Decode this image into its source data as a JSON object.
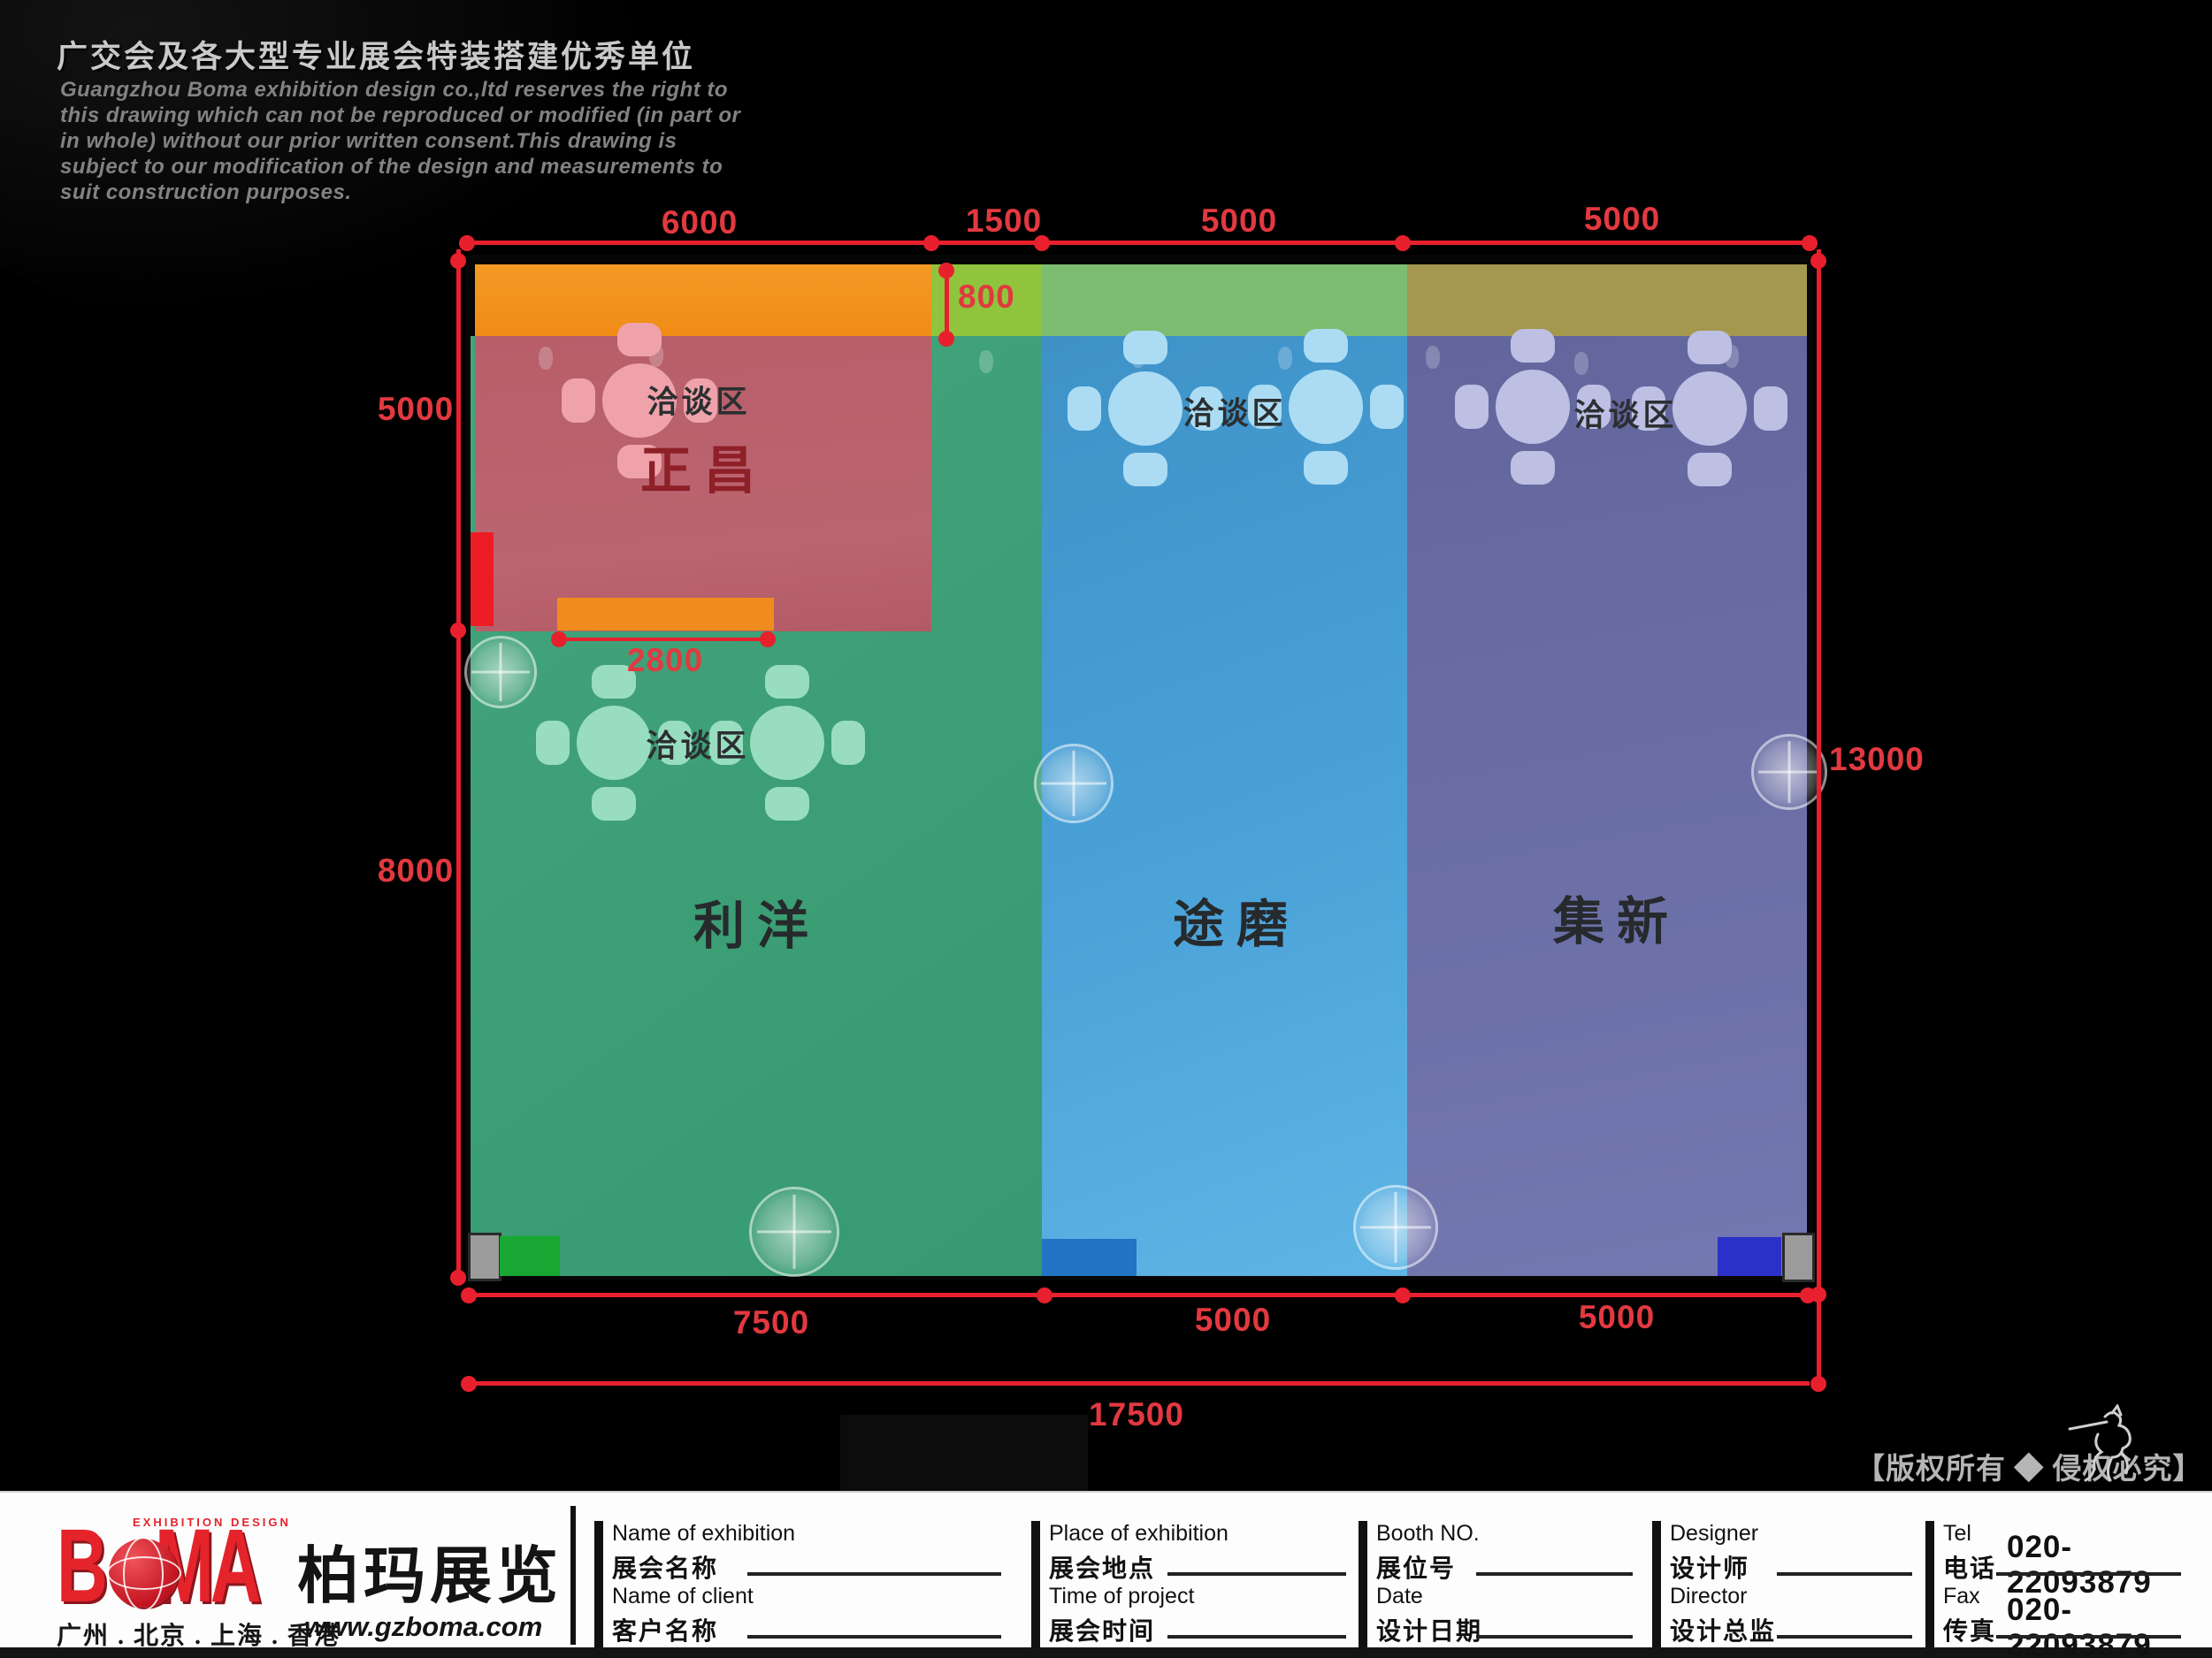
{
  "header": {
    "title": "广交会及各大型专业展会特装搭建优秀单位",
    "disclaimer": [
      "Guangzhou Boma exhibition design co.,ltd reserves the right to",
      "this drawing which can not be reproduced or modified (in part or",
      "in whole) without our prior written consent.This drawing is",
      "subject to our modification of the design and measurements to",
      "suit construction purposes."
    ]
  },
  "plan": {
    "zones": [
      {
        "id": "zhengchang",
        "name": "正昌",
        "meeting_label": "洽谈区",
        "color": "#b9616c"
      },
      {
        "id": "liyang",
        "name": "利洋",
        "meeting_label": "洽谈区",
        "color": "#3fa379"
      },
      {
        "id": "tumo",
        "name": "途磨",
        "meeting_label": "洽谈区",
        "color": "#49a1d6"
      },
      {
        "id": "jixin",
        "name": "集新",
        "meeting_label": "洽谈区",
        "color": "#6b6fa6"
      }
    ],
    "strip_colors": {
      "orange": "#f19220",
      "yellow_green": "#8fc43c",
      "medium_green": "#7cbd71",
      "olive": "#a3984e"
    },
    "dimensions": {
      "top": [
        "6000",
        "1500",
        "5000",
        "5000"
      ],
      "left": [
        "5000",
        "8000"
      ],
      "right": "13000",
      "inner_800": "800",
      "inner_2800": "2800",
      "bottom": [
        "7500",
        "5000",
        "5000"
      ],
      "total": "17500"
    },
    "dimension_color": "#e8202e"
  },
  "footer": {
    "brand": {
      "logo_b": "B",
      "logo_ma": "MA",
      "tagline": "EXHIBITION DESIGN",
      "cn_name": "柏玛展览",
      "cities": "广州 . 北京 . 上海 . 香港",
      "website": "www.gzboma.com"
    },
    "fields": [
      {
        "en": "Name of exhibition",
        "cn": "展会名称"
      },
      {
        "en": "Name of client",
        "cn": "客户名称"
      },
      {
        "en": "Place of exhibition",
        "cn": "展会地点"
      },
      {
        "en": "Time of project",
        "cn": "展会时间"
      },
      {
        "en": "Booth NO.",
        "cn": "展位号"
      },
      {
        "en": "Date",
        "cn": "设计日期"
      },
      {
        "en": "Designer",
        "cn": "设计师"
      },
      {
        "en": "Director",
        "cn": "设计总监"
      },
      {
        "en": "Tel",
        "cn": "电话",
        "value": "020-22093879"
      },
      {
        "en": "Fax",
        "cn": "传真",
        "value": "020-22093879"
      }
    ],
    "copyright": "【版权所有 ◆ 侵权必究】"
  }
}
